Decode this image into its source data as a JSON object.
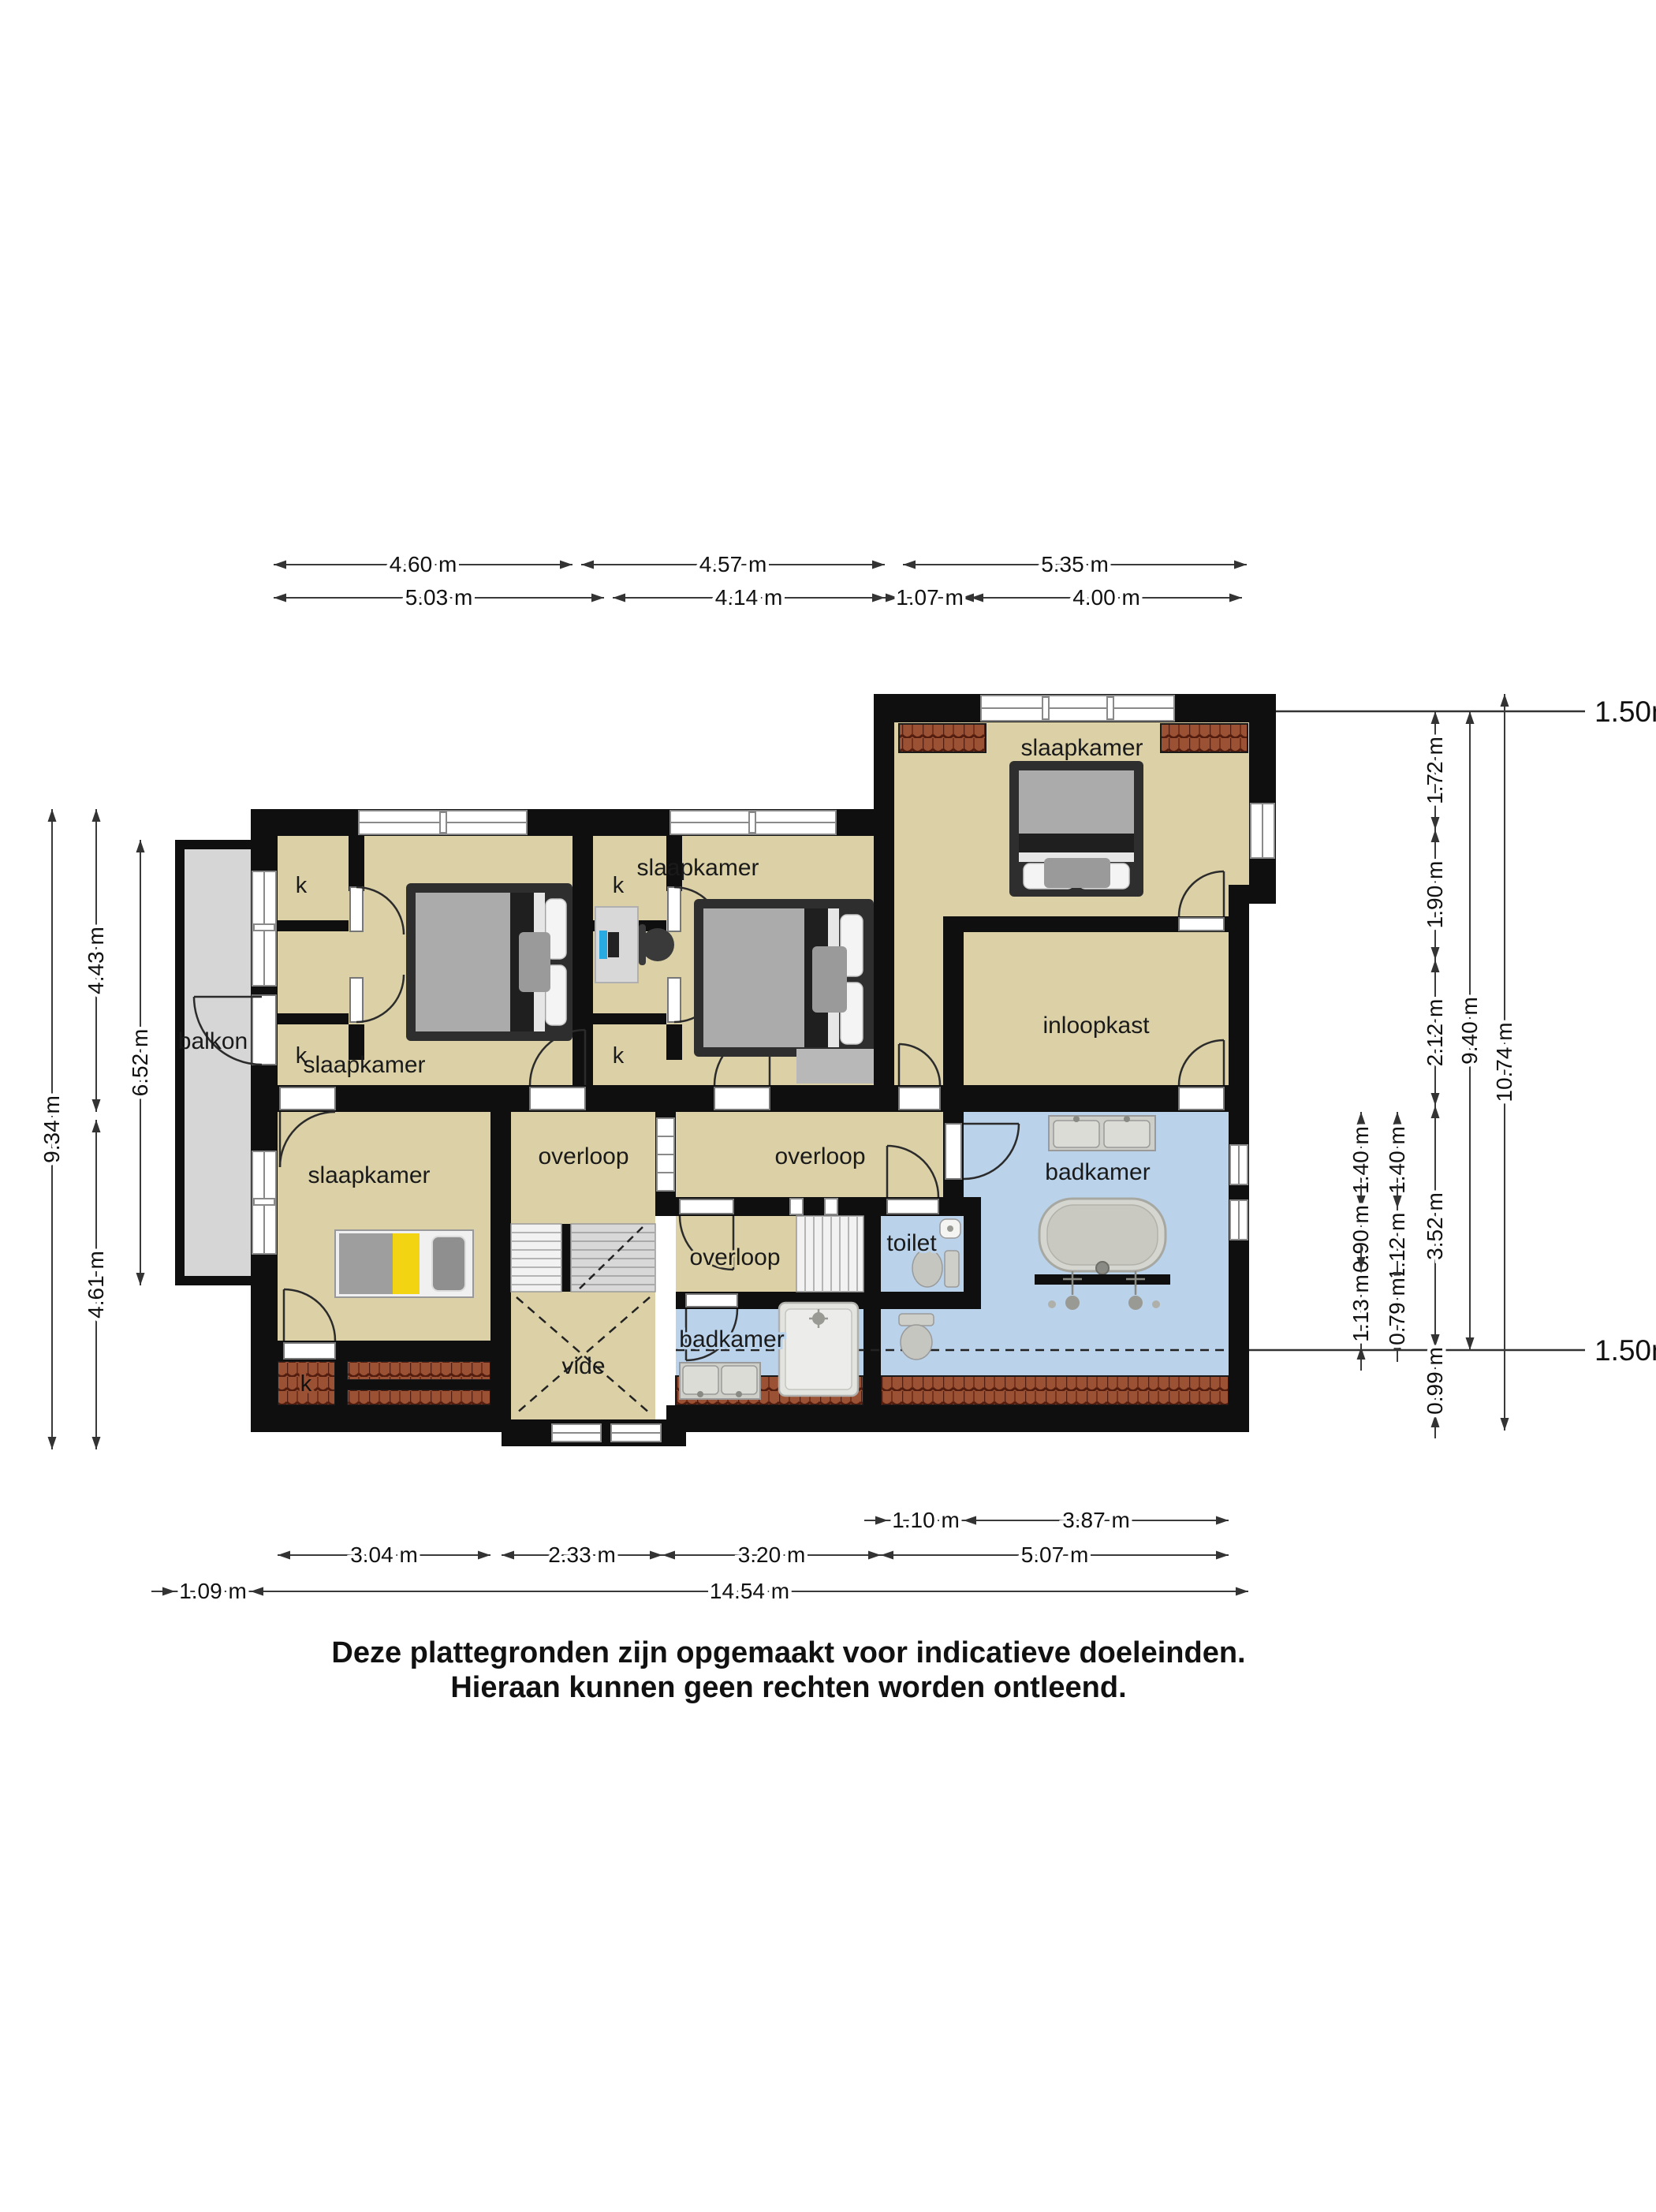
{
  "plan": {
    "rooms": {
      "bedroom_tl": "slaapkamer",
      "bedroom_mid": "slaapkamer",
      "bedroom_tr": "slaapkamer",
      "bedroom_bl": "slaapkamer",
      "walkin_closet": "inloopkast",
      "balcony": "balkon",
      "landing_left": "overloop",
      "landing_main": "overloop",
      "landing_lower": "overloop",
      "bathroom_small": "badkamer",
      "bathroom_main": "badkamer",
      "toilet": "toilet",
      "void": "vide",
      "closet": "k"
    },
    "lines_150": {
      "top": "1.50m lijn",
      "bottom": "1.50m lijn"
    }
  },
  "dimensions": {
    "top_row1": [
      "4.60 m",
      "4.57 m",
      "5.35 m"
    ],
    "top_row2": [
      "5.03 m",
      "4.14 m",
      "1.07 m",
      "4.00 m"
    ],
    "left": [
      "9.34 m",
      "4.43 m",
      "4.61 m",
      "6.52 m"
    ],
    "right_col_a": [
      "1.40 m",
      "0.90 m",
      "1.13 m"
    ],
    "right_col_b": [
      "1.40 m",
      "1.12 m",
      "0.79 m"
    ],
    "right_col_c": [
      "1.72 m",
      "1.90 m",
      "2.12 m",
      "3.52 m",
      "0.99 m"
    ],
    "right_total_inner": "9.40 m",
    "right_total": "10.74 m",
    "bottom_row1": [
      "1.10 m",
      "3.87 m"
    ],
    "bottom_row2": [
      "3.04 m",
      "2.33 m",
      "3.20 m",
      "5.07 m"
    ],
    "bottom_row3": [
      "1.09 m",
      "14.54 m"
    ]
  },
  "footer": {
    "line1": "Deze plattegronden zijn opgemaakt voor indicatieve doeleinden.",
    "line2": "Hieraan kunnen geen rechten worden ontleend."
  },
  "colors": {
    "wall": "#0f0f0f",
    "floor": "#DCD1A6",
    "bathroom_floor": "#BAD3EB",
    "balcony_floor": "#D6D6D6",
    "roof_tile": "#9B5133",
    "roof_tile_dark": "#521D0E",
    "bed_yellow": "#F2D412",
    "monitor_blue": "#29ABE2"
  }
}
